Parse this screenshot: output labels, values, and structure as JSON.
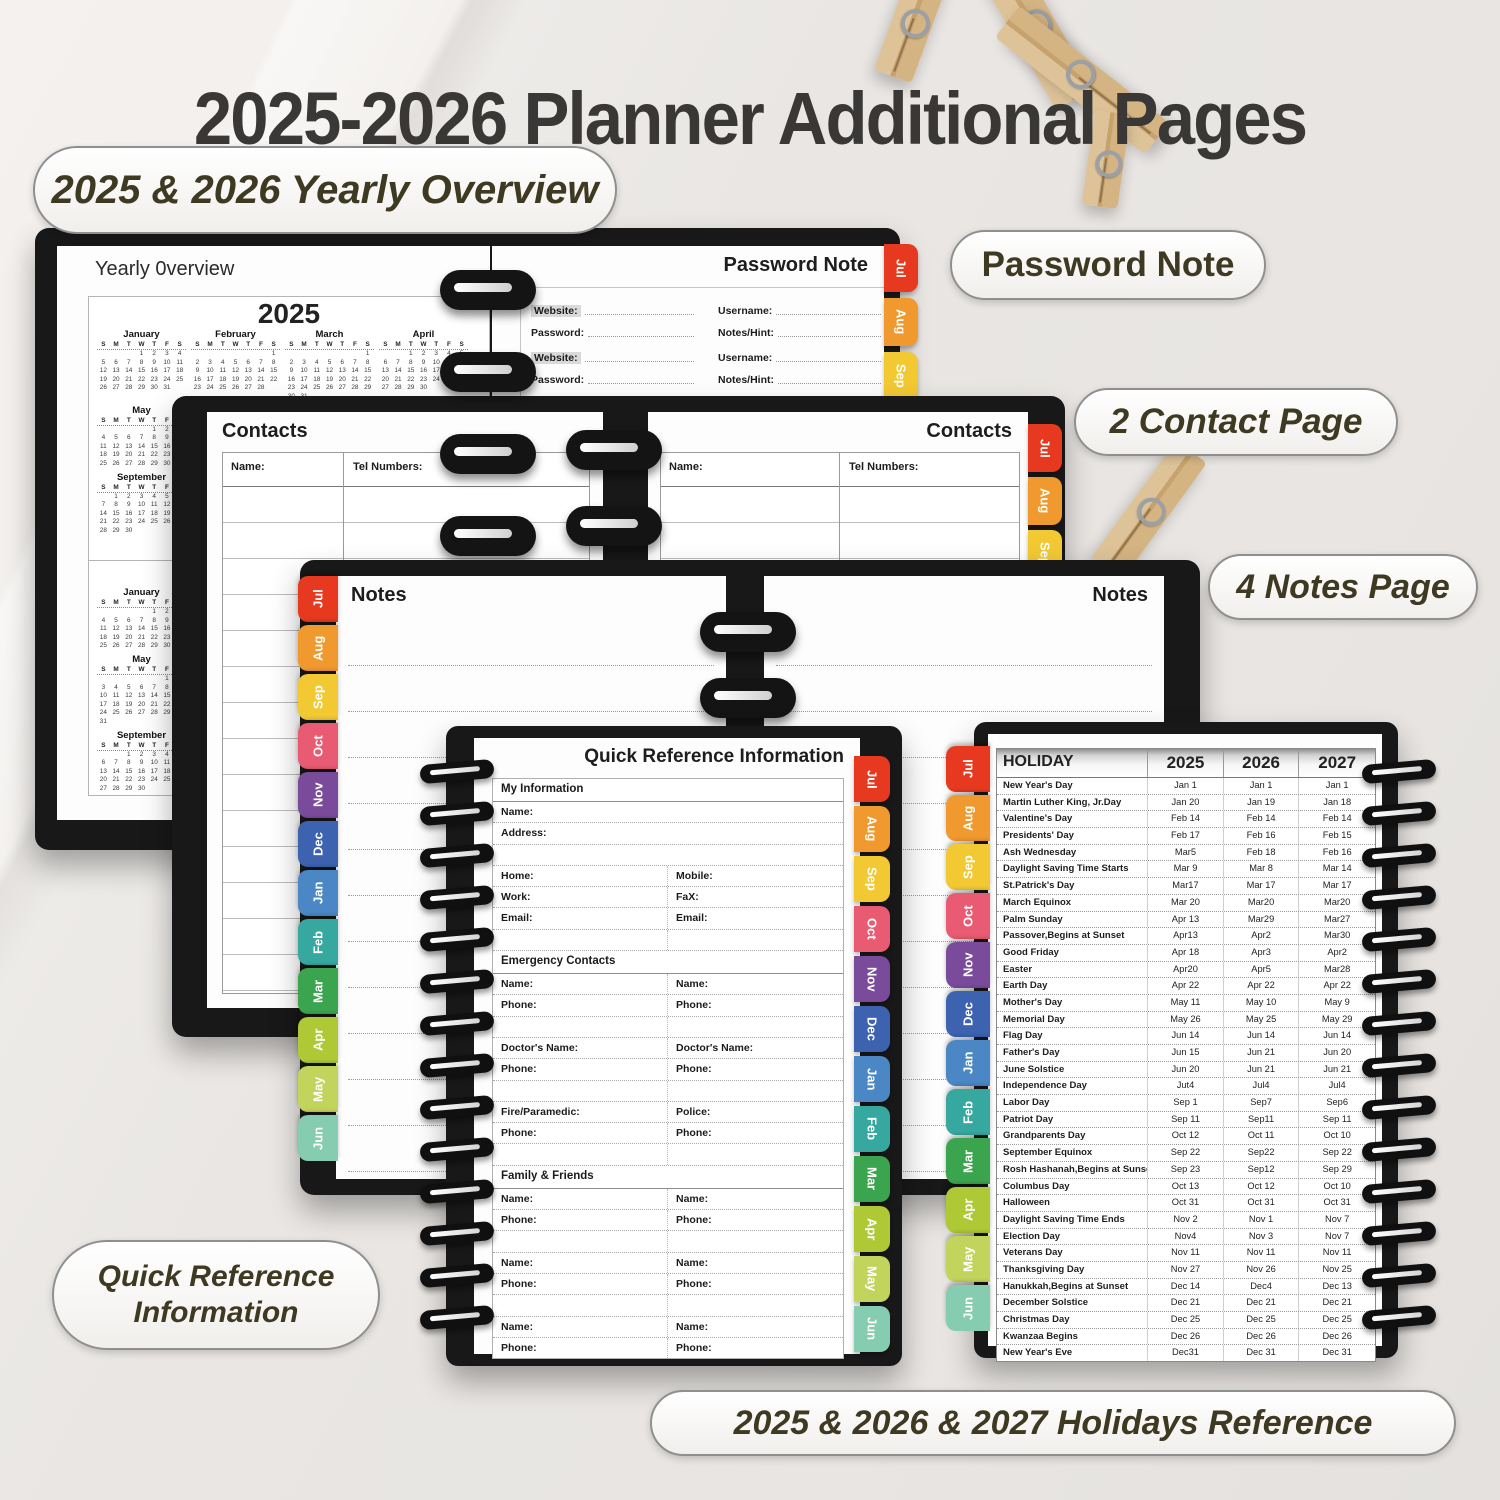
{
  "page": {
    "title": "2025-2026 Planner Additional Pages"
  },
  "callouts": {
    "yearly": "2025 & 2026 Yearly Overview",
    "password": "Password Note",
    "contacts": "2 Contact Page",
    "notes": "4 Notes Page",
    "quick_ref": [
      "Quick Reference",
      "Information"
    ],
    "holidays": "2025 & 2026 & 2027 Holidays Reference"
  },
  "tabs_jas": [
    {
      "label": "Jul",
      "color": "#e6391f"
    },
    {
      "label": "Aug",
      "color": "#f0992e"
    },
    {
      "label": "Sep",
      "color": "#f2c833"
    }
  ],
  "tabs_all": [
    {
      "label": "Jul",
      "color": "#e6391f"
    },
    {
      "label": "Aug",
      "color": "#f0992e"
    },
    {
      "label": "Sep",
      "color": "#f2c833"
    },
    {
      "label": "Oct",
      "color": "#e85b72"
    },
    {
      "label": "Nov",
      "color": "#7a4b9b"
    },
    {
      "label": "Dec",
      "color": "#3d62b0"
    },
    {
      "label": "Jan",
      "color": "#4a87c4"
    },
    {
      "label": "Feb",
      "color": "#37a8a0"
    },
    {
      "label": "Mar",
      "color": "#3ba44e"
    },
    {
      "label": "Apr",
      "color": "#aec836"
    },
    {
      "label": "May",
      "color": "#c3d45c"
    },
    {
      "label": "Jun",
      "color": "#86ccb0"
    }
  ],
  "yearly_overview": {
    "page_title": "Yearly 0verview",
    "day_headers": [
      "S",
      "M",
      "T",
      "W",
      "T",
      "F",
      "S"
    ],
    "calendar_2025": {
      "year": "2025",
      "rows": [
        {
          "months": [
            {
              "name": "January",
              "weeks": [
                [
                  "",
                  "",
                  "",
                  "1",
                  "2",
                  "3",
                  "4"
                ],
                [
                  "5",
                  "6",
                  "7",
                  "8",
                  "9",
                  "10",
                  "11"
                ],
                [
                  "12",
                  "13",
                  "14",
                  "15",
                  "16",
                  "17",
                  "18"
                ],
                [
                  "19",
                  "20",
                  "21",
                  "22",
                  "23",
                  "24",
                  "25"
                ],
                [
                  "26",
                  "27",
                  "28",
                  "29",
                  "30",
                  "31",
                  ""
                ]
              ]
            },
            {
              "name": "February",
              "weeks": [
                [
                  "",
                  "",
                  "",
                  "",
                  "",
                  "",
                  "1"
                ],
                [
                  "2",
                  "3",
                  "4",
                  "5",
                  "6",
                  "7",
                  "8"
                ],
                [
                  "9",
                  "10",
                  "11",
                  "12",
                  "13",
                  "14",
                  "15"
                ],
                [
                  "16",
                  "17",
                  "18",
                  "19",
                  "20",
                  "21",
                  "22"
                ],
                [
                  "23",
                  "24",
                  "25",
                  "26",
                  "27",
                  "28",
                  ""
                ]
              ]
            },
            {
              "name": "March",
              "weeks": [
                [
                  "",
                  "",
                  "",
                  "",
                  "",
                  "",
                  "1"
                ],
                [
                  "2",
                  "3",
                  "4",
                  "5",
                  "6",
                  "7",
                  "8"
                ],
                [
                  "9",
                  "10",
                  "11",
                  "12",
                  "13",
                  "14",
                  "15"
                ],
                [
                  "16",
                  "17",
                  "18",
                  "19",
                  "20",
                  "21",
                  "22"
                ],
                [
                  "23",
                  "24",
                  "25",
                  "26",
                  "27",
                  "28",
                  "29"
                ],
                [
                  "30",
                  "31",
                  "",
                  "",
                  "",
                  "",
                  ""
                ]
              ]
            },
            {
              "name": "April",
              "weeks": [
                [
                  "",
                  "",
                  "1",
                  "2",
                  "3",
                  "4",
                  "5"
                ],
                [
                  "6",
                  "7",
                  "8",
                  "9",
                  "10",
                  "11",
                  "12"
                ],
                [
                  "13",
                  "14",
                  "15",
                  "16",
                  "17",
                  "18",
                  "19"
                ],
                [
                  "20",
                  "21",
                  "22",
                  "23",
                  "24",
                  "25",
                  "26"
                ],
                [
                  "27",
                  "28",
                  "29",
                  "30",
                  "",
                  "",
                  ""
                ]
              ]
            }
          ]
        },
        {
          "months": [
            {
              "name": "May",
              "weeks": [
                [
                  "",
                  "",
                  "",
                  "",
                  "1",
                  "2",
                  "3"
                ],
                [
                  "4",
                  "5",
                  "6",
                  "7",
                  "8",
                  "9",
                  "10"
                ],
                [
                  "11",
                  "12",
                  "13",
                  "14",
                  "15",
                  "16",
                  "17"
                ],
                [
                  "18",
                  "19",
                  "20",
                  "21",
                  "22",
                  "23",
                  "24"
                ],
                [
                  "25",
                  "26",
                  "27",
                  "28",
                  "29",
                  "30",
                  "31"
                ]
              ]
            }
          ]
        },
        {
          "months": [
            {
              "name": "September",
              "weeks": [
                [
                  "",
                  "1",
                  "2",
                  "3",
                  "4",
                  "5",
                  "6"
                ],
                [
                  "7",
                  "8",
                  "9",
                  "10",
                  "11",
                  "12",
                  "13"
                ],
                [
                  "14",
                  "15",
                  "16",
                  "17",
                  "18",
                  "19",
                  "20"
                ],
                [
                  "21",
                  "22",
                  "23",
                  "24",
                  "25",
                  "26",
                  "27"
                ],
                [
                  "28",
                  "29",
                  "30",
                  "",
                  "",
                  "",
                  ""
                ]
              ]
            }
          ]
        }
      ]
    },
    "calendar_2026": {
      "year": "2026",
      "rows": [
        {
          "months": [
            {
              "name": "January",
              "weeks": [
                [
                  "",
                  "",
                  "",
                  "",
                  "1",
                  "2",
                  "3"
                ],
                [
                  "4",
                  "5",
                  "6",
                  "7",
                  "8",
                  "9",
                  "10"
                ],
                [
                  "11",
                  "12",
                  "13",
                  "14",
                  "15",
                  "16",
                  "17"
                ],
                [
                  "18",
                  "19",
                  "20",
                  "21",
                  "22",
                  "23",
                  "24"
                ],
                [
                  "25",
                  "26",
                  "27",
                  "28",
                  "29",
                  "30",
                  "31"
                ]
              ]
            }
          ]
        },
        {
          "months": [
            {
              "name": "May",
              "weeks": [
                [
                  "",
                  "",
                  "",
                  "",
                  "",
                  "1",
                  "2"
                ],
                [
                  "3",
                  "4",
                  "5",
                  "6",
                  "7",
                  "8",
                  "9"
                ],
                [
                  "10",
                  "11",
                  "12",
                  "13",
                  "14",
                  "15",
                  "16"
                ],
                [
                  "17",
                  "18",
                  "19",
                  "20",
                  "21",
                  "22",
                  "23"
                ],
                [
                  "24",
                  "25",
                  "26",
                  "27",
                  "28",
                  "29",
                  "30"
                ],
                [
                  "31",
                  "",
                  "",
                  "",
                  "",
                  "",
                  ""
                ]
              ]
            }
          ]
        },
        {
          "months": [
            {
              "name": "September",
              "weeks": [
                [
                  "",
                  "",
                  "1",
                  "2",
                  "3",
                  "4",
                  "5"
                ],
                [
                  "6",
                  "7",
                  "8",
                  "9",
                  "10",
                  "11",
                  "12"
                ],
                [
                  "13",
                  "14",
                  "15",
                  "16",
                  "17",
                  "18",
                  "19"
                ],
                [
                  "20",
                  "21",
                  "22",
                  "23",
                  "24",
                  "25",
                  "26"
                ],
                [
                  "27",
                  "28",
                  "29",
                  "30",
                  "",
                  "",
                  ""
                ]
              ]
            }
          ]
        }
      ]
    }
  },
  "password_note": {
    "page_title": "Password Note",
    "blocks": [
      {
        "website": "Website:",
        "username": "Username:",
        "password": "Password:",
        "notes_hint": "Notes/Hint:"
      },
      {
        "website": "Website:",
        "username": "Username:",
        "password": "Password:",
        "notes_hint": "Notes/Hint:"
      }
    ],
    "partial_website": "Website:"
  },
  "contacts": {
    "page_title": "Contacts",
    "col_name": "Name:",
    "col_tel": "Tel Numbers:"
  },
  "notes": {
    "page_title": "Notes"
  },
  "quick_reference": {
    "page_title": "Quick Reference Information",
    "rows": [
      {
        "t": "h",
        "l": "My Information"
      },
      {
        "t": "f",
        "l": "Name:"
      },
      {
        "t": "f",
        "l": "Address:"
      },
      {
        "t": "f",
        "l": ""
      },
      {
        "t": "2",
        "l": "Home:",
        "r": "Mobile:"
      },
      {
        "t": "2",
        "l": "Work:",
        "r": "FaX:"
      },
      {
        "t": "2",
        "l": "Email:",
        "r": "Email:"
      },
      {
        "t": "2",
        "l": "",
        "r": ""
      },
      {
        "t": "h",
        "l": "Emergency Contacts"
      },
      {
        "t": "2",
        "l": "Name:",
        "r": "Name:"
      },
      {
        "t": "2",
        "l": "Phone:",
        "r": "Phone:"
      },
      {
        "t": "2",
        "l": "",
        "r": ""
      },
      {
        "t": "2",
        "l": "Doctor's Name:",
        "r": "Doctor's Name:"
      },
      {
        "t": "2",
        "l": "Phone:",
        "r": "Phone:"
      },
      {
        "t": "2",
        "l": "",
        "r": ""
      },
      {
        "t": "2",
        "l": "Fire/Paramedic:",
        "r": "Police:"
      },
      {
        "t": "2",
        "l": "Phone:",
        "r": "Phone:"
      },
      {
        "t": "2",
        "l": "",
        "r": ""
      },
      {
        "t": "h",
        "l": "Family & Friends"
      },
      {
        "t": "2",
        "l": "Name:",
        "r": "Name:"
      },
      {
        "t": "2",
        "l": "Phone:",
        "r": "Phone:"
      },
      {
        "t": "2",
        "l": "",
        "r": ""
      },
      {
        "t": "2",
        "l": "Name:",
        "r": "Name:"
      },
      {
        "t": "2",
        "l": "Phone:",
        "r": "Phone:"
      },
      {
        "t": "2",
        "l": "",
        "r": ""
      },
      {
        "t": "2",
        "l": "Name:",
        "r": "Name:"
      },
      {
        "t": "2",
        "l": "Phone:",
        "r": "Phone:"
      }
    ]
  },
  "holiday": {
    "headers": [
      "HOLIDAY",
      "2025",
      "2026",
      "2027"
    ],
    "rows": [
      [
        "New Year's Day",
        "Jan 1",
        "Jan 1",
        "Jan 1"
      ],
      [
        "Martin Luther King, Jr.Day",
        "Jan 20",
        "Jan 19",
        "Jan 18"
      ],
      [
        "Valentine's Day",
        "Feb 14",
        "Feb 14",
        "Feb 14"
      ],
      [
        "Presidents' Day",
        "Feb 17",
        "Feb 16",
        "Feb 15"
      ],
      [
        "Ash Wednesday",
        "Mar5",
        "Feb 18",
        "Feb 16"
      ],
      [
        "Daylight Saving Time Starts",
        "Mar 9",
        "Mar 8",
        "Mar 14"
      ],
      [
        "St.Patrick's Day",
        "Mar17",
        "Mar 17",
        "Mar 17"
      ],
      [
        "March Equinox",
        "Mar 20",
        "Mar20",
        "Mar20"
      ],
      [
        "Palm Sunday",
        "Apr 13",
        "Mar29",
        "Mar27"
      ],
      [
        "Passover,Begins at Sunset",
        "Apr13",
        "Apr2",
        "Mar30"
      ],
      [
        "Good Friday",
        "Apr 18",
        "Apr3",
        "Apr2"
      ],
      [
        "Easter",
        "Apr20",
        "Apr5",
        "Mar28"
      ],
      [
        "Earth Day",
        "Apr 22",
        "Apr 22",
        "Apr 22"
      ],
      [
        "Mother's Day",
        "May 11",
        "May 10",
        "May 9"
      ],
      [
        "Memorial Day",
        "May 26",
        "May 25",
        "May 29"
      ],
      [
        "Flag Day",
        "Jun 14",
        "Jun 14",
        "Jun 14"
      ],
      [
        "Father's Day",
        "Jun 15",
        "Jun 21",
        "Jun 20"
      ],
      [
        "June Solstice",
        "Jun 20",
        "Jun 21",
        "Jun 21"
      ],
      [
        "Independence Day",
        "Jut4",
        "Jul4",
        "Jul4"
      ],
      [
        "Labor Day",
        "Sep 1",
        "Sep7",
        "Sep6"
      ],
      [
        "Patriot Day",
        "Sep 11",
        "Sep11",
        "Sep 11"
      ],
      [
        "Grandparents Day",
        "Oct 12",
        "Oct 11",
        "Oct 10"
      ],
      [
        "September Equinox",
        "Sep 22",
        "Sep22",
        "Sep 22"
      ],
      [
        "Rosh Hashanah,Begins at Sunset",
        "Sep 23",
        "Sep12",
        "Sep 29"
      ],
      [
        "Columbus Day",
        "Oct 13",
        "Oct 12",
        "Oct 10"
      ],
      [
        "Halloween",
        "Oct 31",
        "Oct 31",
        "Oct 31"
      ],
      [
        "Daylight Saving Time Ends",
        "Nov 2",
        "Nov 1",
        "Nov 7"
      ],
      [
        "Election Day",
        "Nov4",
        "Nov 3",
        "Nov 7"
      ],
      [
        "Veterans Day",
        "Nov 11",
        "Nov 11",
        "Nov 11"
      ],
      [
        "Thanksgiving Day",
        "Nov 27",
        "Nov 26",
        "Nov 25"
      ],
      [
        "Hanukkah,Begins at Sunset",
        "Dec 14",
        "Dec4",
        "Dec 13"
      ],
      [
        "December Solstice",
        "Dec 21",
        "Dec 21",
        "Dec 21"
      ],
      [
        "Christmas Day",
        "Dec 25",
        "Dec 25",
        "Dec 25"
      ],
      [
        "Kwanzaa Begins",
        "Dec 26",
        "Dec 26",
        "Dec 26"
      ],
      [
        "New Year's Eve",
        "Dec31",
        "Dec 31",
        "Dec 31"
      ]
    ]
  }
}
